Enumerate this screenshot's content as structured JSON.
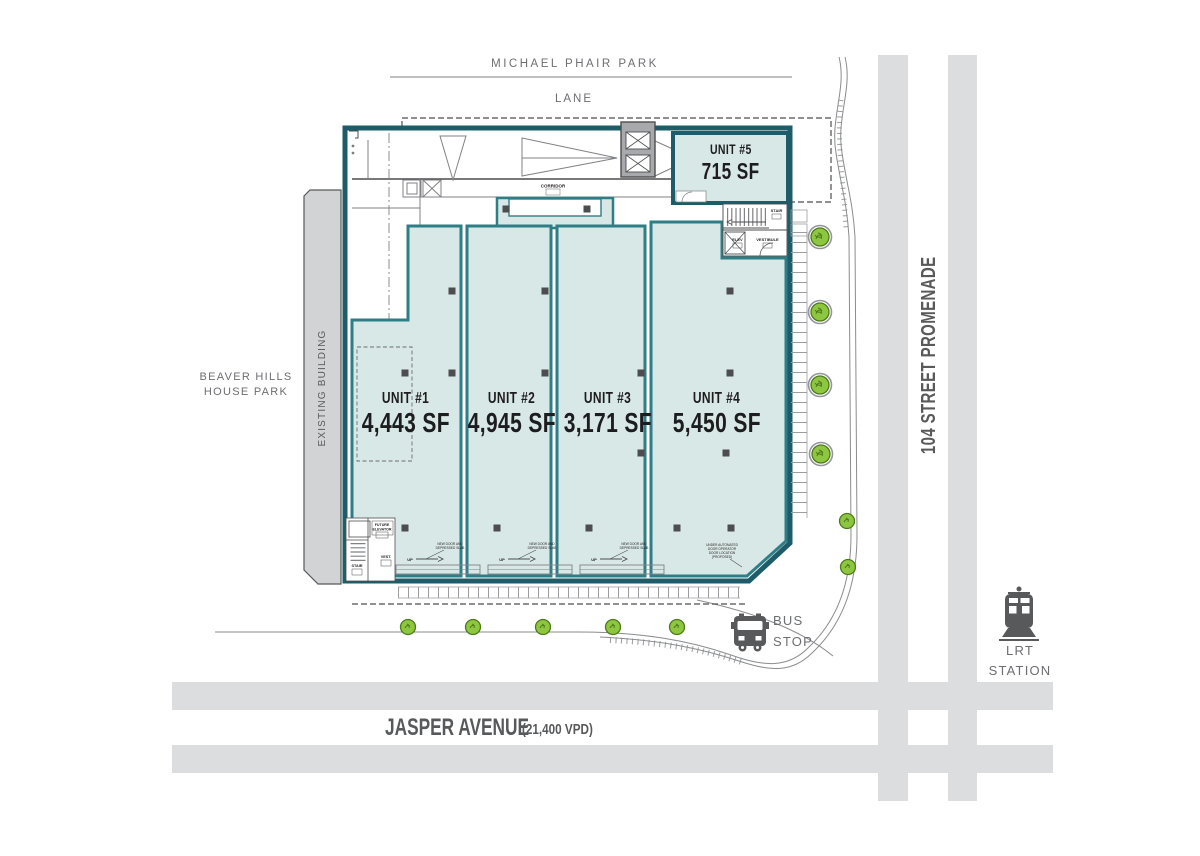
{
  "parks": {
    "michael_phair": "MICHAEL PHAIR PARK",
    "beaver_line1": "BEAVER HILLS",
    "beaver_line2": "HOUSE PARK"
  },
  "streets": {
    "lane": "LANE",
    "jasper": "JASPER AVENUE",
    "jasper_traffic": "(21,400 VPD)",
    "promenade": "104 STREET PROMENADE"
  },
  "transit": {
    "bus_line1": "BUS",
    "bus_line2": "STOP",
    "lrt_line1": "LRT",
    "lrt_line2": "STATION"
  },
  "existing_building": "EXISTING BUILDING",
  "units": [
    {
      "name": "UNIT #1",
      "area": "4,443 SF"
    },
    {
      "name": "UNIT #2",
      "area": "4,945 SF"
    },
    {
      "name": "UNIT #3",
      "area": "3,171 SF"
    },
    {
      "name": "UNIT #4",
      "area": "5,450 SF"
    },
    {
      "name": "UNIT #5",
      "area": "715 SF"
    }
  ],
  "plan_labels": {
    "corridor": "CORRIDOR",
    "stair": "STAIR",
    "elev": "ELEV",
    "vestibule": "VESTIBULE",
    "future_elevator_line1": "FUTURE",
    "future_elevator_line2": "ELEVATOR",
    "vest": "VEST.",
    "up": "UP",
    "slope_line1": "NEW DOOR AND",
    "slope_line2": "DEPRESSED SLAB",
    "auto_line1": "UNDER AUTOMATED",
    "auto_line2": "DOOR OPERATOR",
    "auto_line3": "DOOR LOCATION",
    "auto_line4": "(PROPOSED)"
  },
  "colors": {
    "outline_teal": "#1e5c69",
    "wall_teal": "#2e7e85",
    "unit_fill": "#d8e8e6",
    "road_gray": "#dcddde",
    "label_gray": "#6d6e71",
    "dark_gray": "#58595b",
    "tree_green": "#8dc63f"
  }
}
